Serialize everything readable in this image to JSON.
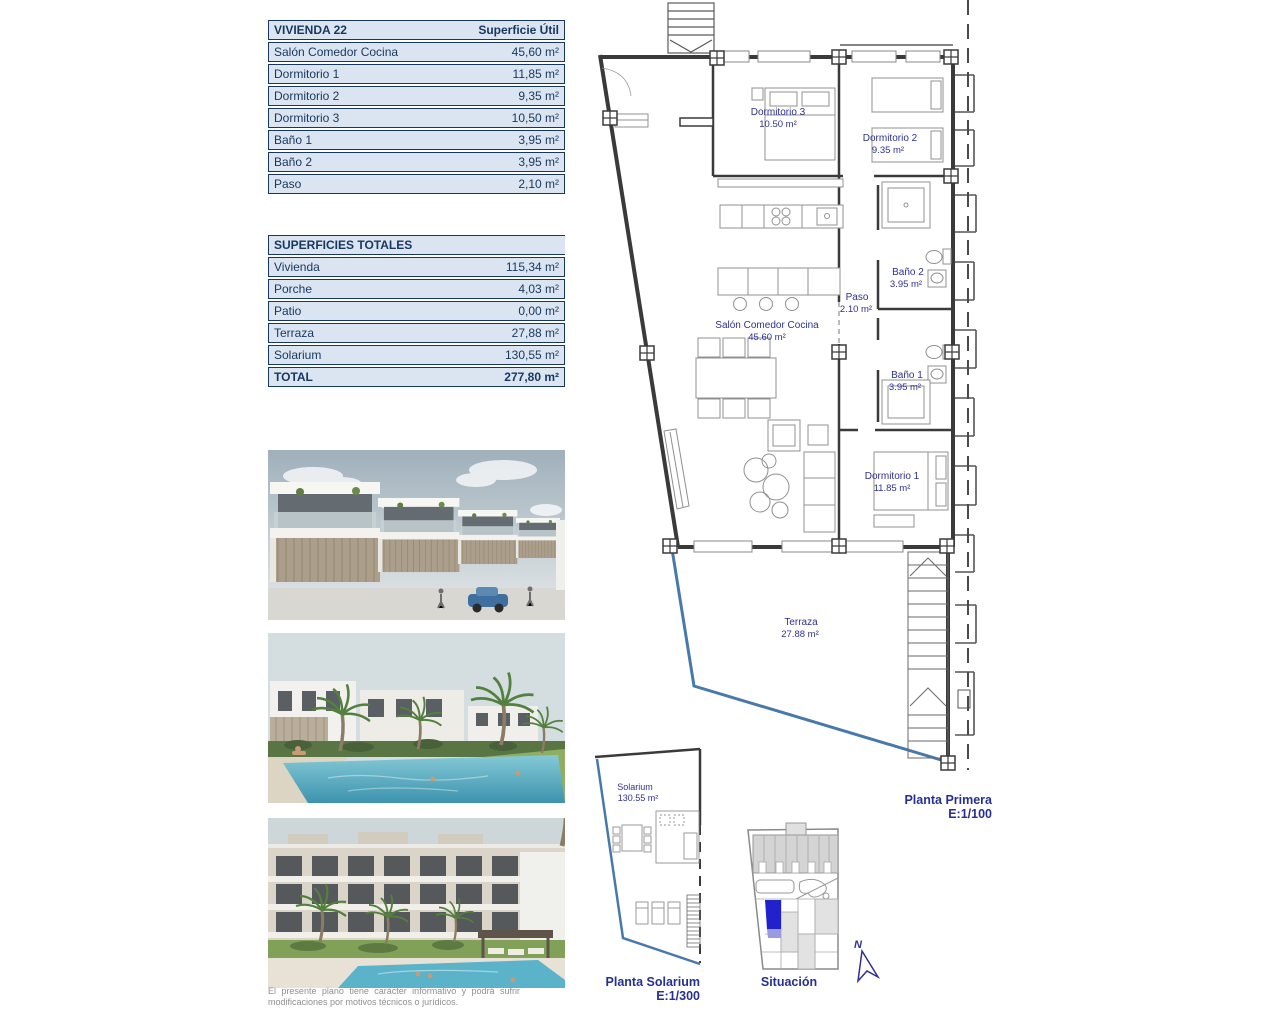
{
  "colors": {
    "table_fill": "#dbe5f1",
    "table_border": "#17375e",
    "table_text": "#17375e",
    "plan_label": "#2e3192",
    "caption": "#27308f",
    "terrace_line": "#4779aa",
    "wall": "#3a3a3a",
    "furniture": "#909090",
    "situacion_highlight": "#2222cc",
    "situacion_highlight_light": "#9a9ade",
    "disclaimer_text": "#8f8f8f"
  },
  "vivienda_table": {
    "title": "VIVIENDA 22",
    "header_right": "Superficie Útil",
    "rows": [
      {
        "label": "Salón Comedor Cocina",
        "value": "45,60 m²"
      },
      {
        "label": "Dormitorio 1",
        "value": "11,85 m²"
      },
      {
        "label": "Dormitorio 2",
        "value": "9,35 m²"
      },
      {
        "label": "Dormitorio 3",
        "value": "10,50 m²"
      },
      {
        "label": "Baño 1",
        "value": "3,95 m²"
      },
      {
        "label": "Baño 2",
        "value": "3,95 m²"
      },
      {
        "label": "Paso",
        "value": "2,10 m²"
      }
    ]
  },
  "superficies_table": {
    "title": "SUPERFICIES TOTALES",
    "rows": [
      {
        "label": "Vivienda",
        "value": "115,34 m²"
      },
      {
        "label": "Porche",
        "value": "4,03 m²"
      },
      {
        "label": "Patio",
        "value": "0,00 m²"
      },
      {
        "label": "Terraza",
        "value": "27,88 m²"
      },
      {
        "label": "Solarium",
        "value": "130,55 m²"
      }
    ],
    "total_label": "TOTAL",
    "total_value": "277,80 m²"
  },
  "floor_plan": {
    "rooms": {
      "dormitorio3": {
        "name": "Dormitorio 3",
        "area": "10.50 m²"
      },
      "dormitorio2": {
        "name": "Dormitorio 2",
        "area": "9.35 m²"
      },
      "bano2": {
        "name": "Baño 2",
        "area": "3.95 m²"
      },
      "paso": {
        "name": "Paso",
        "area": "2.10 m²"
      },
      "salon": {
        "name": "Salón Comedor Cocina",
        "area": "45.60 m²"
      },
      "bano1": {
        "name": "Baño 1",
        "area": "3.95 m²"
      },
      "dormitorio1": {
        "name": "Dormitorio 1",
        "area": "11.85 m²"
      },
      "terraza": {
        "name": "Terraza",
        "area": "27.88 m²"
      }
    },
    "caption_title": "Planta Primera",
    "caption_scale": "E:1/100"
  },
  "solarium_plan": {
    "room_name": "Solarium",
    "room_area": "130.55 m²",
    "caption_title": "Planta Solarium",
    "caption_scale": "E:1/300"
  },
  "situacion": {
    "caption": "Situación",
    "north_label": "N"
  },
  "disclaimer": "El presente plano tiene carácter informativo y podrá sufrir modificaciones por motivos técnicos o jurídicos."
}
